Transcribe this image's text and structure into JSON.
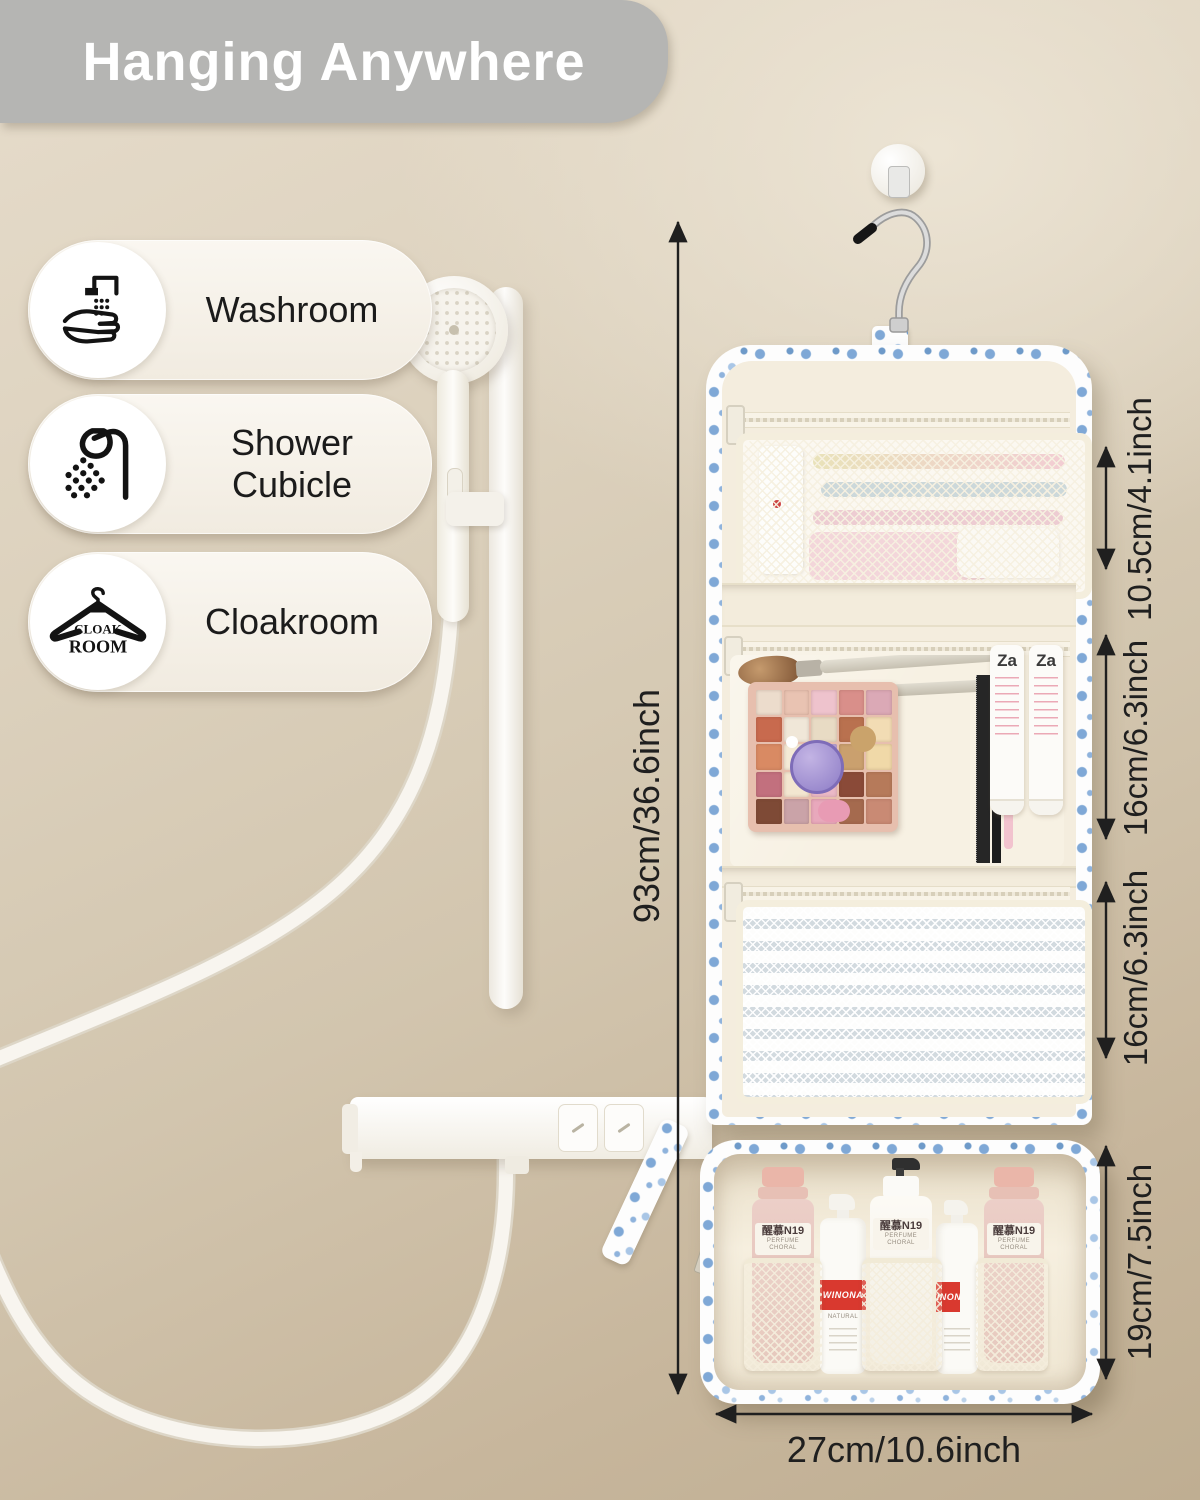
{
  "banner": {
    "title": "Hanging Anywhere"
  },
  "locations": {
    "items": [
      {
        "label": "Washroom",
        "icon": "wash-hands-icon"
      },
      {
        "label": "Shower Cubicle",
        "icon": "shower-head-icon"
      },
      {
        "label": "Cloakroom",
        "icon": "coat-hanger-icon",
        "badge_line1": "CLOAK",
        "badge_line2": "ROOM"
      }
    ]
  },
  "dimensions": {
    "total_height": "93cm/36.6inch",
    "pocket_top": "10.5cm/4.1inch",
    "pocket_middle": "16cm/6.3inch",
    "pocket_lower": "16cm/6.3inch",
    "pouch_bottom": "19cm/7.5inch",
    "width": "27cm/10.6inch"
  },
  "products": {
    "za_label": "Za",
    "bottle_brand": "醒慕N19",
    "bottle_sub": "PERFUME CHORAL",
    "pump_brand": "WINONA",
    "pump_sub": "NATURAL"
  },
  "colors": {
    "banner_bg": "#b5b5b3",
    "wall_light": "#e6dccb",
    "wall_dark": "#bfae92",
    "floral_blue": "#7fa8d6",
    "lining_cream": "#f4edde",
    "dimension_text": "#1f1f1f",
    "winona_red": "#d9392f"
  },
  "palette_colors": [
    "#ecdccc",
    "#e9c3b2",
    "#eec3cd",
    "#d98f8a",
    "#dba9b6",
    "#c86a4e",
    "#f0e7d8",
    "#e8dbc4",
    "#b9714f",
    "#f2dcb4",
    "#d98a63",
    "#f4ead6",
    "#b9a4d8",
    "#caa06e",
    "#f0d9a8",
    "#c2707e",
    "#f3e6d0",
    "#eab9c6",
    "#8a4a38",
    "#b67a5a",
    "#7e4a36",
    "#caa3a8",
    "#e8a8bc",
    "#a56a4e",
    "#c98a74"
  ]
}
